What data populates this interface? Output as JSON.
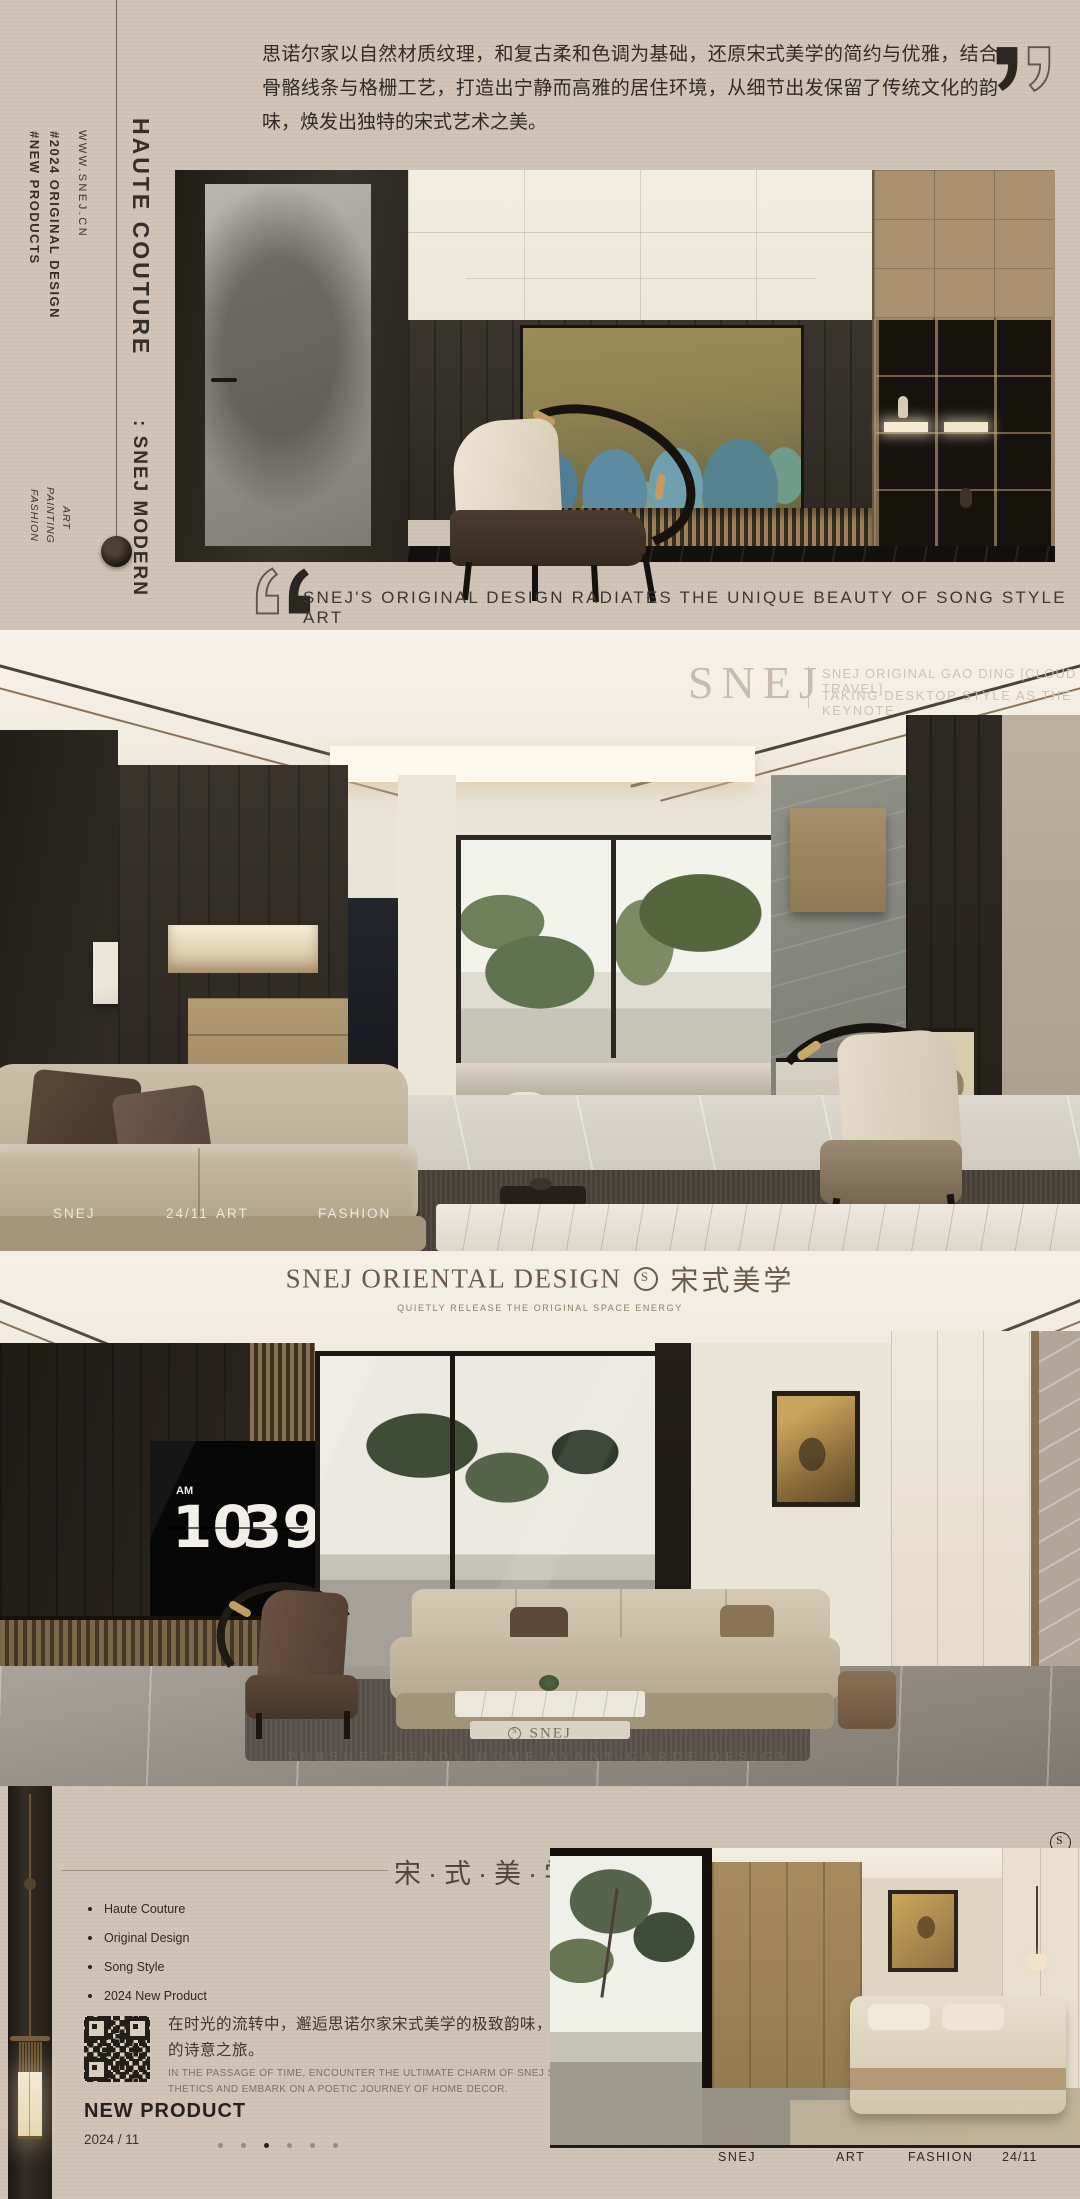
{
  "colors": {
    "background": "#cec3b5",
    "ink": "#2e2b27",
    "bronze": "#8a7256",
    "cream_panel": "#f0ebdf",
    "dark_wood": "#2b2723",
    "tv_screen": "#0a0a0a"
  },
  "left_rail": {
    "headline": "HAUTE COUTURE",
    "website": "WWW.SNEJ.CN",
    "tags": [
      "#2024 ORIGINAL DESIGN",
      "#NEW PRODUCTS"
    ],
    "modern_label": ": SNEJ MODERN",
    "keywords": [
      "ART",
      "PAINTING",
      "FASHION"
    ]
  },
  "intro": {
    "paragraph": "思诺尔家以自然材质纹理，和复古柔和色调为基础，还原宋式美学的简约与优雅，结合骨骼线条与格栅工艺，打造出宁静而高雅的居住环境，从细节出发保留了传统文化的韵味，焕发出独特的宋式艺术之美。",
    "quote": "SNEJ'S ORIGINAL DESIGN RADIATES THE UNIQUE BEAUTY OF SONG STYLE ART"
  },
  "living_section": {
    "watermark_brand": "SNEJ",
    "caption_lines": [
      "SNEJ ORIGINAL GAO DING [CLOUD TRAVEL]",
      "TAKING DESKTOP STYLE AS THE KEYNOTE"
    ],
    "footer": [
      "SNEJ",
      "24/11",
      "ART",
      "FASHION"
    ]
  },
  "oriental_section": {
    "title_en": "SNEJ ORIENTAL DESIGN",
    "title_cn": "宋式美学",
    "subtitle": "QUIETLY RELEASE THE ORIGINAL SPACE ENERGY",
    "tv_clock": {
      "meridiem": "AM",
      "hour": "10",
      "minute": "39"
    },
    "floor_brand": "SNEJ",
    "floor_tagline": "PURSUE TRENDY HOME AVANT-GARDE DESIGN"
  },
  "new_product_section": {
    "title_cn": "宋·式·美·学",
    "bullets": [
      "Haute Couture",
      "Original Design",
      "Song Style",
      "2024 New Product"
    ],
    "body_cn": [
      "在时光的流转中，邂逅思诺尔家宋式美学的极致韵味，开启家居",
      "的诗意之旅。"
    ],
    "body_en": [
      "IN THE PASSAGE OF TIME, ENCOUNTER THE ULTIMATE CHARM OF SNEJ SONG STYLE AES-",
      "THETICS AND EMBARK ON A POETIC JOURNEY OF HOME DECOR."
    ],
    "label": "NEW PRODUCT",
    "date": "2024 / 11",
    "pager": {
      "total": 6,
      "active": 2
    },
    "bottom_bar": [
      "SNEJ",
      "ART",
      "FASHION",
      "24/11"
    ]
  }
}
